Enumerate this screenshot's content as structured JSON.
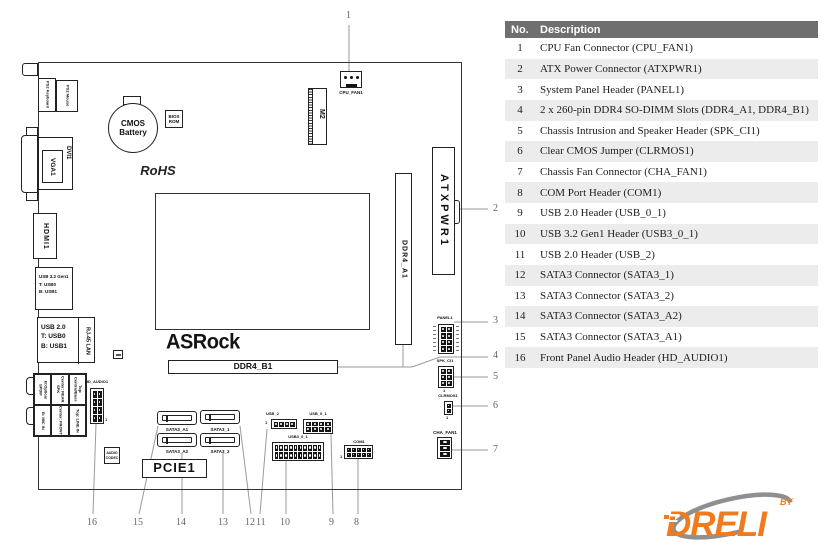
{
  "legend": {
    "col_no": "No.",
    "col_description": "Description",
    "rows": [
      {
        "no": "1",
        "desc": "CPU Fan Connector (CPU_FAN1)"
      },
      {
        "no": "2",
        "desc": "ATX Power Connector (ATXPWR1)"
      },
      {
        "no": "3",
        "desc": "System Panel Header (PANEL1)"
      },
      {
        "no": "4",
        "desc": "2 x 260-pin DDR4 SO-DIMM Slots (DDR4_A1, DDR4_B1)"
      },
      {
        "no": "5",
        "desc": "Chassis Intrusion and Speaker Header (SPK_CI1)"
      },
      {
        "no": "6",
        "desc": "Clear CMOS Jumper (CLRMOS1)"
      },
      {
        "no": "7",
        "desc": "Chassis Fan Connector (CHA_FAN1)"
      },
      {
        "no": "8",
        "desc": "COM Port Header (COM1)"
      },
      {
        "no": "9",
        "desc": "USB 2.0 Header (USB_0_1)"
      },
      {
        "no": "10",
        "desc": "USB 3.2 Gen1 Header (USB3_0_1)"
      },
      {
        "no": "11",
        "desc": "USB 2.0 Header (USB_2)"
      },
      {
        "no": "12",
        "desc": "SATA3 Connector (SATA3_1)"
      },
      {
        "no": "13",
        "desc": "SATA3 Connector (SATA3_2)"
      },
      {
        "no": "14",
        "desc": "SATA3 Connector (SATA3_A2)"
      },
      {
        "no": "15",
        "desc": "SATA3 Connector (SATA3_A1)"
      },
      {
        "no": "16",
        "desc": "Front Panel Audio Header (HD_AUDIO1)"
      }
    ]
  },
  "board": {
    "labels": {
      "ps2_keyboard": "PS2 Keyboard",
      "ps2_mouse": "PS2 Mouse",
      "cmos_battery": "CMOS Battery",
      "bios_rom": "BIOS ROM",
      "dvi1": "DVI1",
      "vga1": "VGA1",
      "rohs": "RoHS",
      "hdmi1": "HDMI1",
      "usb32_l1": "USB 3.2 Gen1",
      "usb32_l2": "T: USB0",
      "usb32_l3": "B: USB1",
      "usb20_l1": "USB 2.0",
      "usb20_l2": "T: USB0",
      "usb20_l3": "B: USB1",
      "rj45": "RJ-45 LAN",
      "hd_audio1": "HD_AUDIO1",
      "audio_codec": "AUDIO CODEC",
      "asrock": "ASRock",
      "ddr4_b1": "DDR4_B1",
      "ddr4_a1": "DDR4_A1",
      "m2": "M2",
      "cpu_fan1": "CPU_FAN1",
      "atxpwr1": "ATXPWR1",
      "panel1": "PANEL1",
      "spk_ci1": "SPK_CI1",
      "clrmos1": "CLRMOS1",
      "cha_fan1": "CHA_FAN1",
      "sata3_a1": "SATA3_A1",
      "sata3_1": "SATA3_1",
      "sata3_a2": "SATA3_A2",
      "sata3_2": "SATA3_2",
      "pcie1": "PCIE1",
      "usb_2": "USB_2",
      "usb_0_1": "USB_0_1",
      "usb3_0_1": "USB3_0_1",
      "com1": "COM1",
      "pin1": "1"
    },
    "audio_jacks": [
      "B:Optical SPDIF",
      "Center: REAR SPK",
      "Top: Central/Bass",
      "B: MIC IN",
      "Center: FRONT",
      "Top: LINE IN"
    ],
    "callouts": [
      "1",
      "2",
      "3",
      "4",
      "5",
      "6",
      "7",
      "8",
      "9",
      "10",
      "11",
      "12",
      "13",
      "14",
      "15",
      "16"
    ]
  },
  "branding": {
    "name": "DRELI",
    "by": "BY"
  },
  "colors": {
    "table_header_bg": "#6F6F6F",
    "table_row_alt": "#ECECEC",
    "leader_line": "#9A9A9A",
    "logo_orange": "#F07B1F",
    "logo_gray": "#8F8F8F"
  }
}
